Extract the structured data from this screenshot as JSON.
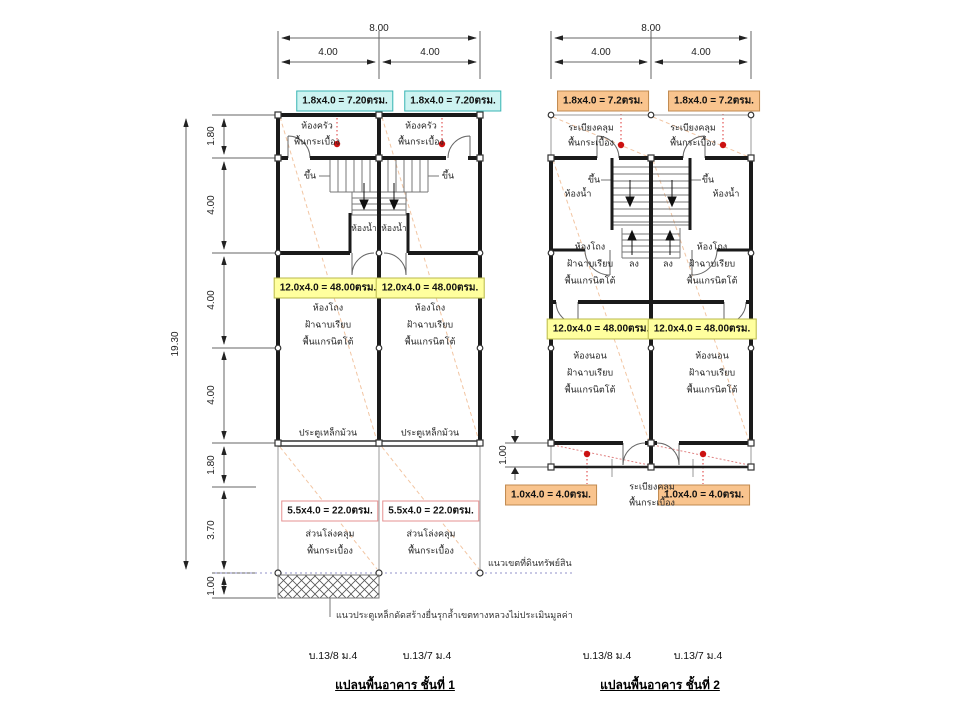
{
  "colors": {
    "wall": "#1a1a1a",
    "thin_line": "#888888",
    "dim_line": "#555555",
    "red_dot": "#cc1111",
    "red_leader": "#dd3333",
    "pale_diagonal": "#f2c5a2",
    "boundary_line": "#9090c8",
    "cyan_label_bg": "#cdf3f1",
    "orange_label_bg": "#f9c48e",
    "yellow_label_bg": "#ffff9e",
    "pink_label_border": "#e59090"
  },
  "plan1": {
    "dims_top": {
      "total": "8.00",
      "left": "4.00",
      "right": "4.00"
    },
    "dims_left": {
      "total": "19.30",
      "segments": [
        "1.80",
        "4.00",
        "4.00",
        "4.00",
        "1.80",
        "3.70",
        "1.00"
      ]
    },
    "area_top": "1.8x4.0 = 7.20ตรม.",
    "area_hall": "12.0x4.0 = 48.00ตรม.",
    "area_covered": "5.5x4.0 = 22.0ตรม.",
    "kitchen_name": "ห้องครัว",
    "kitchen_floor": "พื้นกระเบื้อง",
    "stair_up": "ขึ้น",
    "bath": "ห้องน้ำ",
    "hall_name": "ห้องโถง",
    "hall_ceiling": "ฝ้าฉาบเรียบ",
    "hall_floor": "พื้นแกรนิตโต้",
    "rolling_door": "ประตูเหล็กม้วน",
    "covered_name": "ส่วนโล่งคลุม",
    "covered_floor": "พื้นกระเบื้อง",
    "boundary_label": "แนวเขตที่ดินทรัพย์สิน",
    "encroach_note": "แนวประตูเหล็กดัดสร้างยื่นรุกล้ำเขตทางหลวงไม่ประเมินมูลค่า",
    "unit_left": "บ.13/8 ม.4",
    "unit_right": "บ.13/7 ม.4",
    "title": "แปลนพื้นอาคาร ชั้นที่ 1"
  },
  "plan2": {
    "dims_top": {
      "total": "8.00",
      "left": "4.00",
      "right": "4.00"
    },
    "dim_balcony": "1.00",
    "area_top": "1.8x4.0 = 7.2ตรม.",
    "area_hall": "12.0x4.0 = 48.00ตรม.",
    "area_balcony": "1.0x4.0 = 4.0ตรม.",
    "balcony_name": "ระเบียงคลุม",
    "balcony_floor": "พื้นกระเบื้อง",
    "bath": "ห้องน้ำ",
    "stair_up": "ขึ้น",
    "stair_down": "ลง",
    "hall_name": "ห้องโถง",
    "hall_ceiling": "ฝ้าฉาบเรียบ",
    "hall_floor": "พื้นแกรนิตโต้",
    "bedroom_name": "ห้องนอน",
    "bedroom_ceiling": "ฝ้าฉาบเรียบ",
    "bedroom_floor": "พื้นแกรนิตโต้",
    "unit_left": "บ.13/8 ม.4",
    "unit_right": "บ.13/7 ม.4",
    "title": "แปลนพื้นอาคาร ชั้นที่ 2"
  }
}
